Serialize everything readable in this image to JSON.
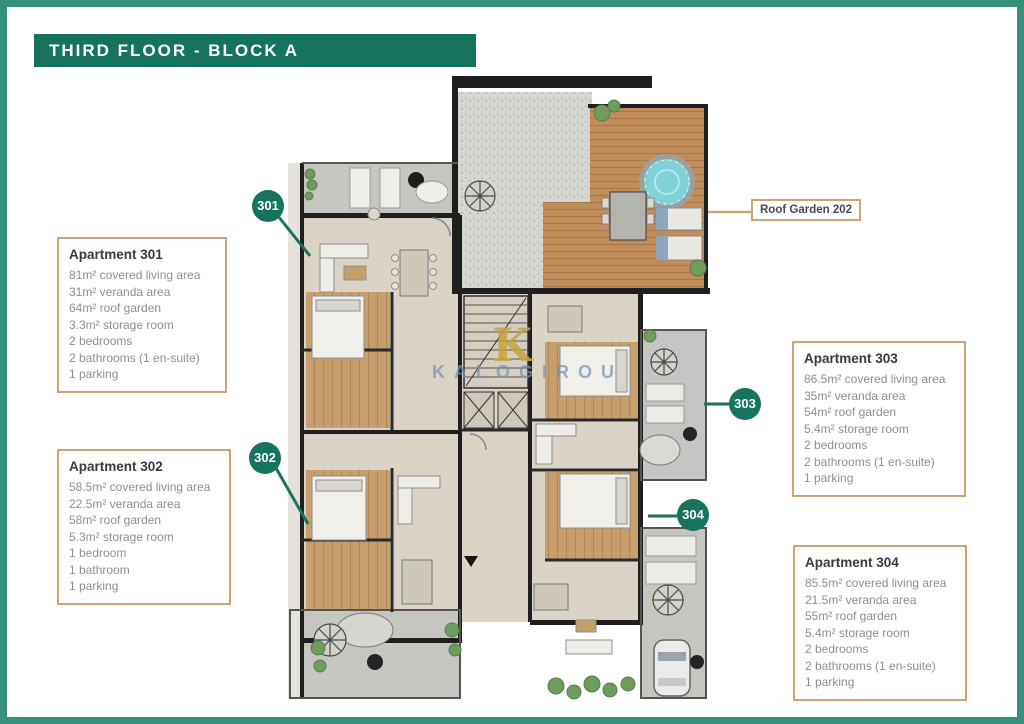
{
  "header": {
    "title": "THIRD FLOOR - BLOCK A"
  },
  "plan": {
    "roof_garden_label": "Roof Garden 202",
    "watermark_letter": "K",
    "watermark_text": "KALOGIROU",
    "badges": [
      {
        "label": "301"
      },
      {
        "label": "302"
      },
      {
        "label": "303"
      },
      {
        "label": "304"
      }
    ]
  },
  "apartments": [
    {
      "name": "Apartment 301",
      "lines": [
        "81m² covered living area",
        "31m² veranda area",
        "64m² roof garden",
        "3.3m² storage room",
        "2 bedrooms",
        "2 bathrooms (1 en-suite)",
        "1 parking"
      ]
    },
    {
      "name": "Apartment 302",
      "lines": [
        "58.5m² covered living area",
        "22.5m² veranda area",
        "58m² roof garden",
        "5.3m² storage room",
        "1 bedroom",
        "1 bathroom",
        "1 parking"
      ]
    },
    {
      "name": "Apartment 303",
      "lines": [
        "86.5m² covered living area",
        "35m² veranda area",
        "54m² roof garden",
        "5.4m² storage room",
        "2 bedrooms",
        "2 bathrooms (1 en-suite)",
        "1 parking"
      ]
    },
    {
      "name": "Apartment 304",
      "lines": [
        "85.5m² covered living area",
        "21.5m² veranda area",
        "55m² roof garden",
        "5.4m² storage room",
        "2 bedrooms",
        "2 bathrooms (1 en-suite)",
        "1 parking"
      ]
    }
  ],
  "colors": {
    "accent_green": "#15735E",
    "frame_teal": "#37907B",
    "box_border_tan": "#C9A677"
  }
}
